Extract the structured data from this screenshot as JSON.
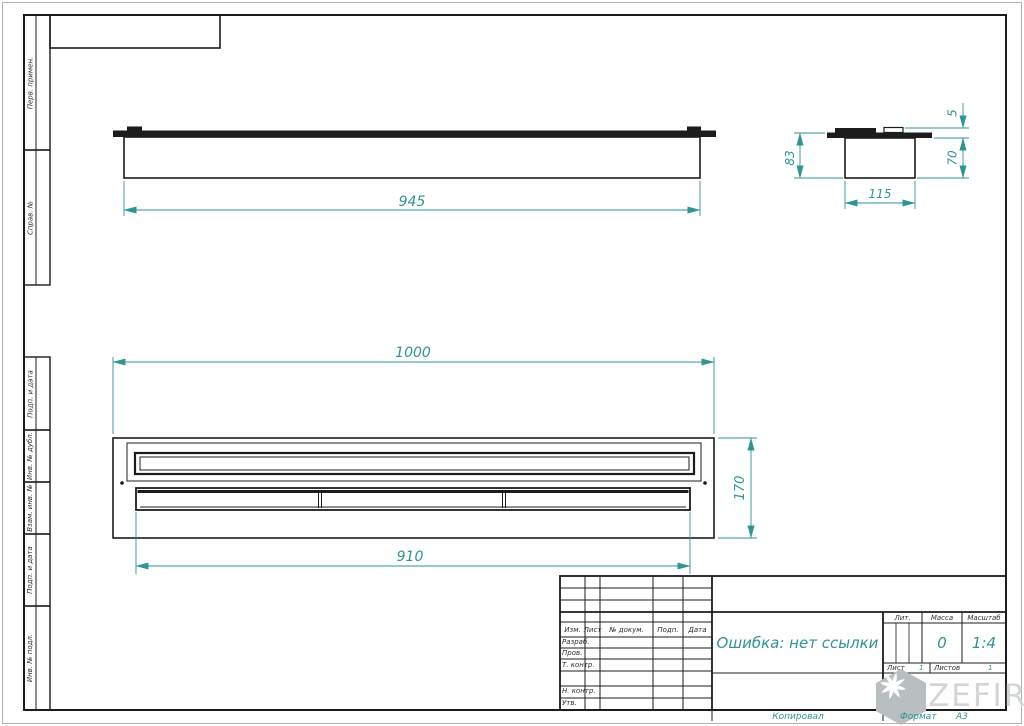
{
  "drawing": {
    "views": {
      "front": {
        "length": "945"
      },
      "side": {
        "overall_height": "83",
        "width": "115",
        "body_height": "70",
        "tab_height": "5"
      },
      "top": {
        "overall_length": "1000",
        "depth": "170",
        "lid_length": "910"
      }
    }
  },
  "margin": {
    "top_group": [
      "Перв. примен.",
      "Справ. №"
    ],
    "bottom_group": [
      "Подп. и дата",
      "Инв. № дубл.",
      "Взам. инв. №",
      "Подп. и дата",
      "Инв. № подл."
    ]
  },
  "title_block": {
    "header_cols": [
      "Изм.",
      "Лист",
      "№ докум.",
      "Подп.",
      "Дата"
    ],
    "roles": [
      "Разраб.",
      "Пров.",
      "Т. контр.",
      "Н. контр.",
      "Утв."
    ],
    "name_value": "Ошибка: нет ссылки",
    "lit_label": "Лит.",
    "mass_label": "Масса",
    "mass_value": "0",
    "scale_label": "Масштаб",
    "scale_value": "1:4",
    "sheet_label": "Лист",
    "sheet_value": "1",
    "sheets_label": "Листов",
    "sheets_value": "1"
  },
  "footer": {
    "copied": "Копировал",
    "format_label": "Формат",
    "format_value": "А3"
  },
  "watermark": {
    "text": "ZEFIRE"
  },
  "colors": {
    "dimension": "#2e9494",
    "drawing_line": "#1c1c1c",
    "watermark": "#d3d6d7"
  }
}
